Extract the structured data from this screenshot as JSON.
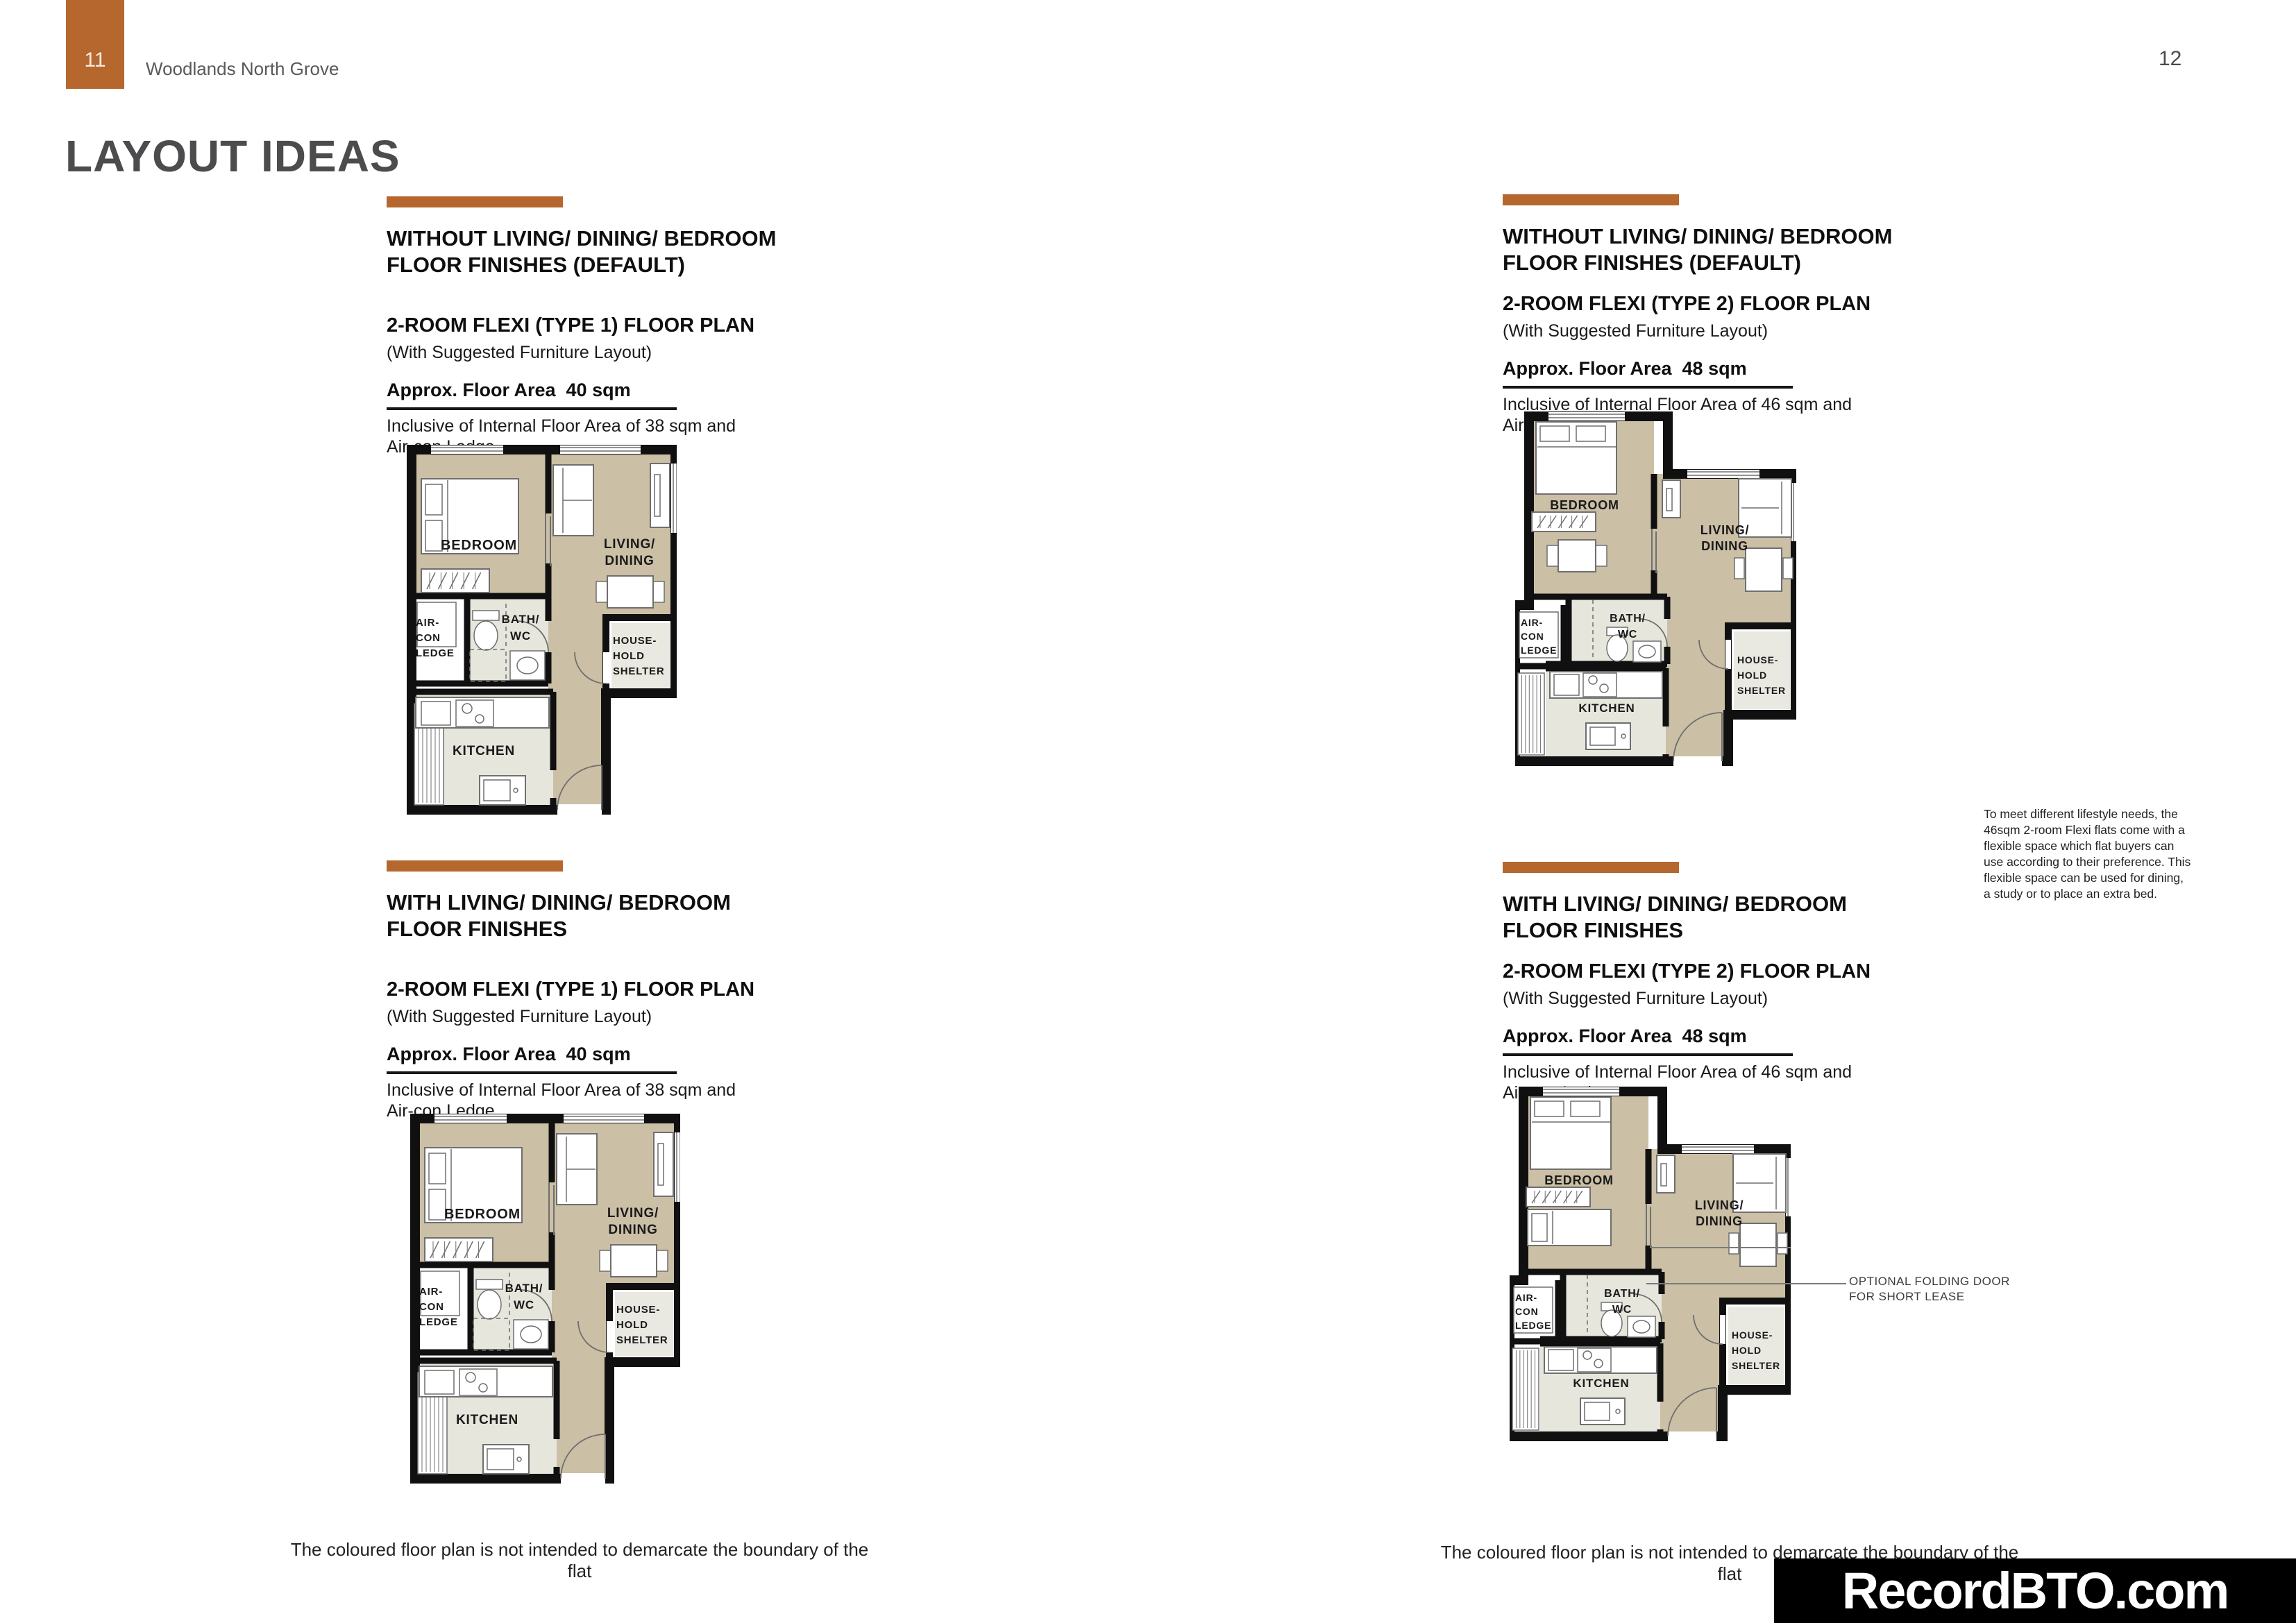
{
  "page": {
    "left_page_number": "11",
    "project_name": "Woodlands North Grove",
    "right_page_number": "12",
    "title": "LAYOUT IDEAS",
    "watermark": "RecordBTO.com",
    "footer_note_left": "The coloured floor plan is not intended to demarcate the boundary of the flat",
    "footer_note_right": "The coloured floor plan is not intended to demarcate the boundary of the flat"
  },
  "colors": {
    "accent": "#b5672e",
    "title_gray": "#4c4c4e",
    "floor_beige": "#cbbfa5",
    "floor_gray": "#e6e6dd",
    "shelter_gray": "#e9e9e2",
    "wall": "#101010"
  },
  "sections": [
    {
      "heading_line1": "WITHOUT LIVING/ DINING/ BEDROOM",
      "heading_line2": "FLOOR FINISHES (DEFAULT)",
      "plan_title": "2-ROOM FLEXI (TYPE 1) FLOOR PLAN",
      "plan_subtitle": "(With Suggested Furniture Layout)",
      "area_label": "Approx. Floor Area  40 sqm",
      "area_note_line1": "Inclusive of Internal Floor Area of 38 sqm and",
      "area_note_line2": "Air-con Ledge"
    },
    {
      "heading_line1": "WITHOUT LIVING/ DINING/ BEDROOM",
      "heading_line2": "FLOOR FINISHES (DEFAULT)",
      "plan_title": "2-ROOM FLEXI (TYPE 2) FLOOR PLAN",
      "plan_subtitle": "(With Suggested Furniture Layout)",
      "area_label": "Approx. Floor Area  48 sqm",
      "area_note_line1": "Inclusive of Internal Floor Area of 46 sqm and",
      "area_note_line2": "Air-con Ledge"
    },
    {
      "heading_line1": "WITH LIVING/ DINING/ BEDROOM",
      "heading_line2": "FLOOR FINISHES",
      "plan_title": "2-ROOM FLEXI (TYPE 1) FLOOR PLAN",
      "plan_subtitle": "(With Suggested Furniture Layout)",
      "area_label": "Approx. Floor Area  40 sqm",
      "area_note_line1": "Inclusive of Internal Floor Area of 38 sqm and",
      "area_note_line2": "Air-con Ledge"
    },
    {
      "heading_line1": "WITH LIVING/ DINING/ BEDROOM",
      "heading_line2": "FLOOR FINISHES",
      "plan_title": "2-ROOM FLEXI (TYPE 2) FLOOR PLAN",
      "plan_subtitle": "(With Suggested Furniture Layout)",
      "area_label": "Approx. Floor Area  48 sqm",
      "area_note_line1": "Inclusive of Internal Floor Area of 46 sqm and",
      "area_note_line2": "Air-con Ledge"
    }
  ],
  "side_note": {
    "text": "To meet different lifestyle needs, the 46sqm 2-room Flexi flats come with a flexible space which flat buyers can use according to their preference. This flexible space can be used for dining, a study or to place an extra bed."
  },
  "annotation": {
    "line1": "OPTIONAL FOLDING DOOR",
    "line2": "FOR SHORT LEASE"
  },
  "room_labels": {
    "bedroom": "BEDROOM",
    "living_1": "LIVING/",
    "living_2": "DINING",
    "bath_1": "BATH/",
    "bath_2": "WC",
    "aircon_1": "AIR-",
    "aircon_2": "CON",
    "aircon_3": "LEDGE",
    "kitchen": "KITCHEN",
    "shelter_1": "HOUSE-",
    "shelter_2": "HOLD",
    "shelter_3": "SHELTER"
  },
  "plans": [
    {
      "id": "plan1",
      "type": "type1",
      "extra_bed": false
    },
    {
      "id": "plan2",
      "type": "type2",
      "extra_bed": false
    },
    {
      "id": "plan3",
      "type": "type1",
      "extra_bed": false
    },
    {
      "id": "plan4",
      "type": "type2",
      "extra_bed": true
    }
  ]
}
